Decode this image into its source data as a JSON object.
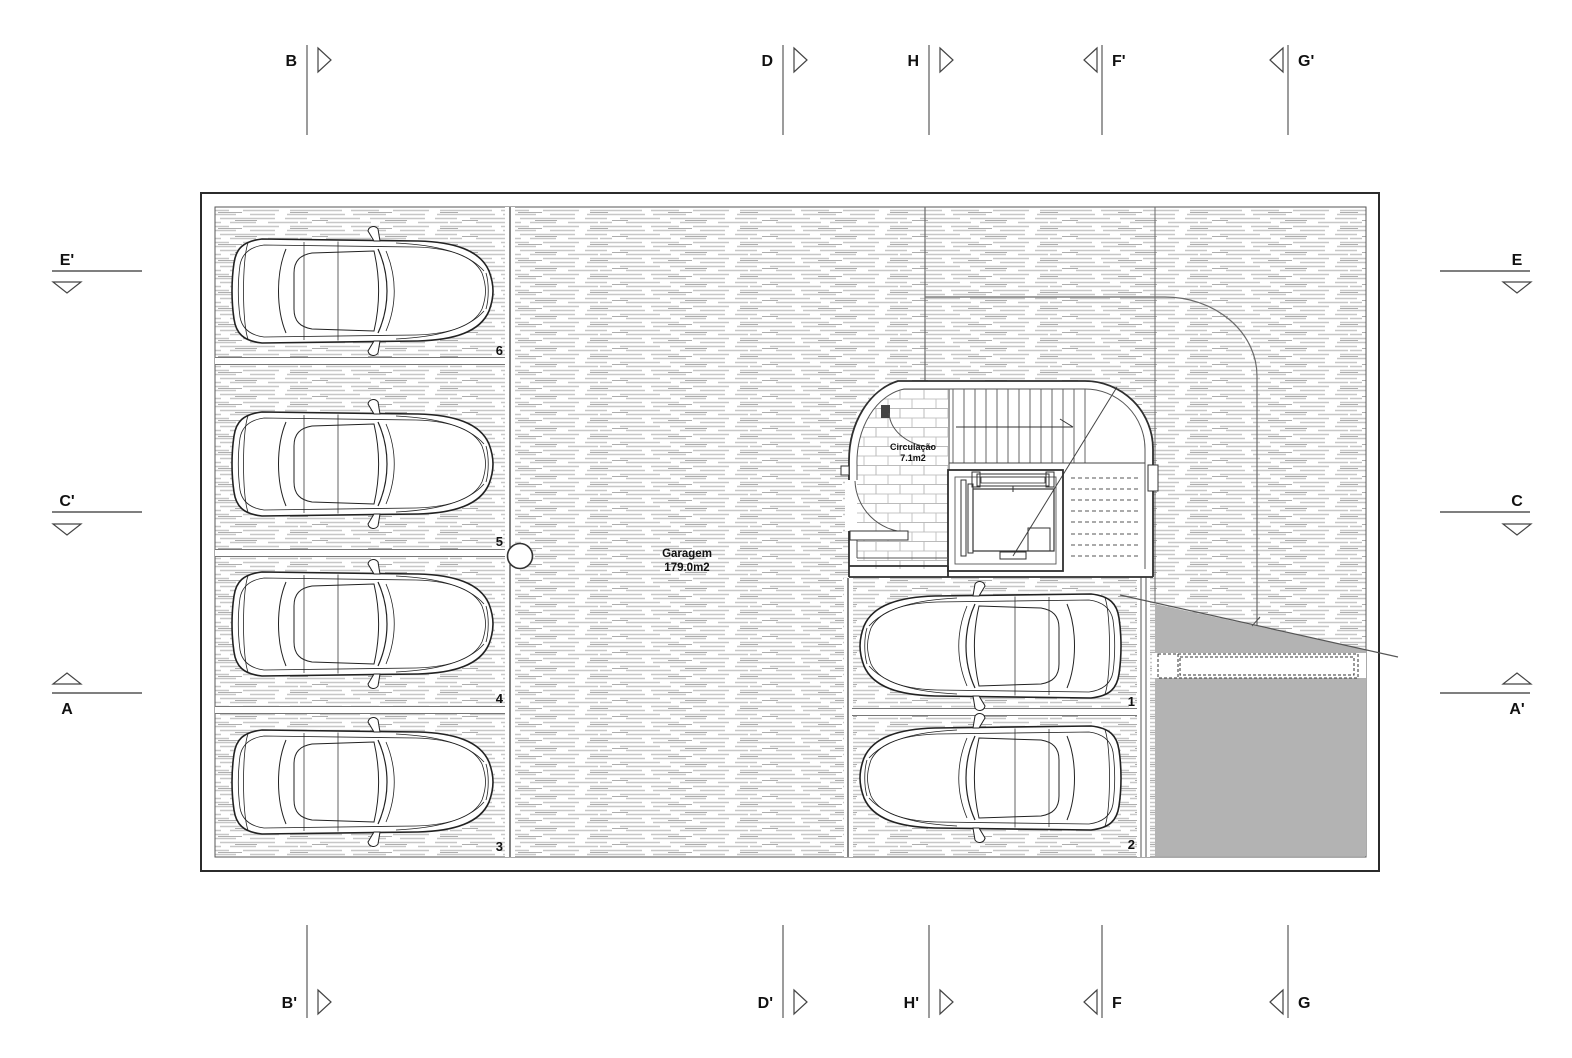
{
  "drawing": {
    "garage": {
      "name": "Garagem",
      "area": "179.0m2"
    },
    "circulation": {
      "name": "Circulação",
      "area": "7.1m2"
    },
    "stalls": [
      "1",
      "2",
      "3",
      "4",
      "5",
      "6"
    ],
    "markers": {
      "top": [
        "B",
        "D",
        "H",
        "F'",
        "G'"
      ],
      "bottom": [
        "B'",
        "D'",
        "H'",
        "F",
        "G"
      ],
      "left": [
        "E'",
        "C'",
        "A"
      ],
      "right": [
        "E",
        "C",
        "A'"
      ]
    },
    "colors": {
      "ramp_gray": "#b3b3b3",
      "hatch_line": "#c7c7c7",
      "line_dark": "#2f2f2f"
    }
  }
}
